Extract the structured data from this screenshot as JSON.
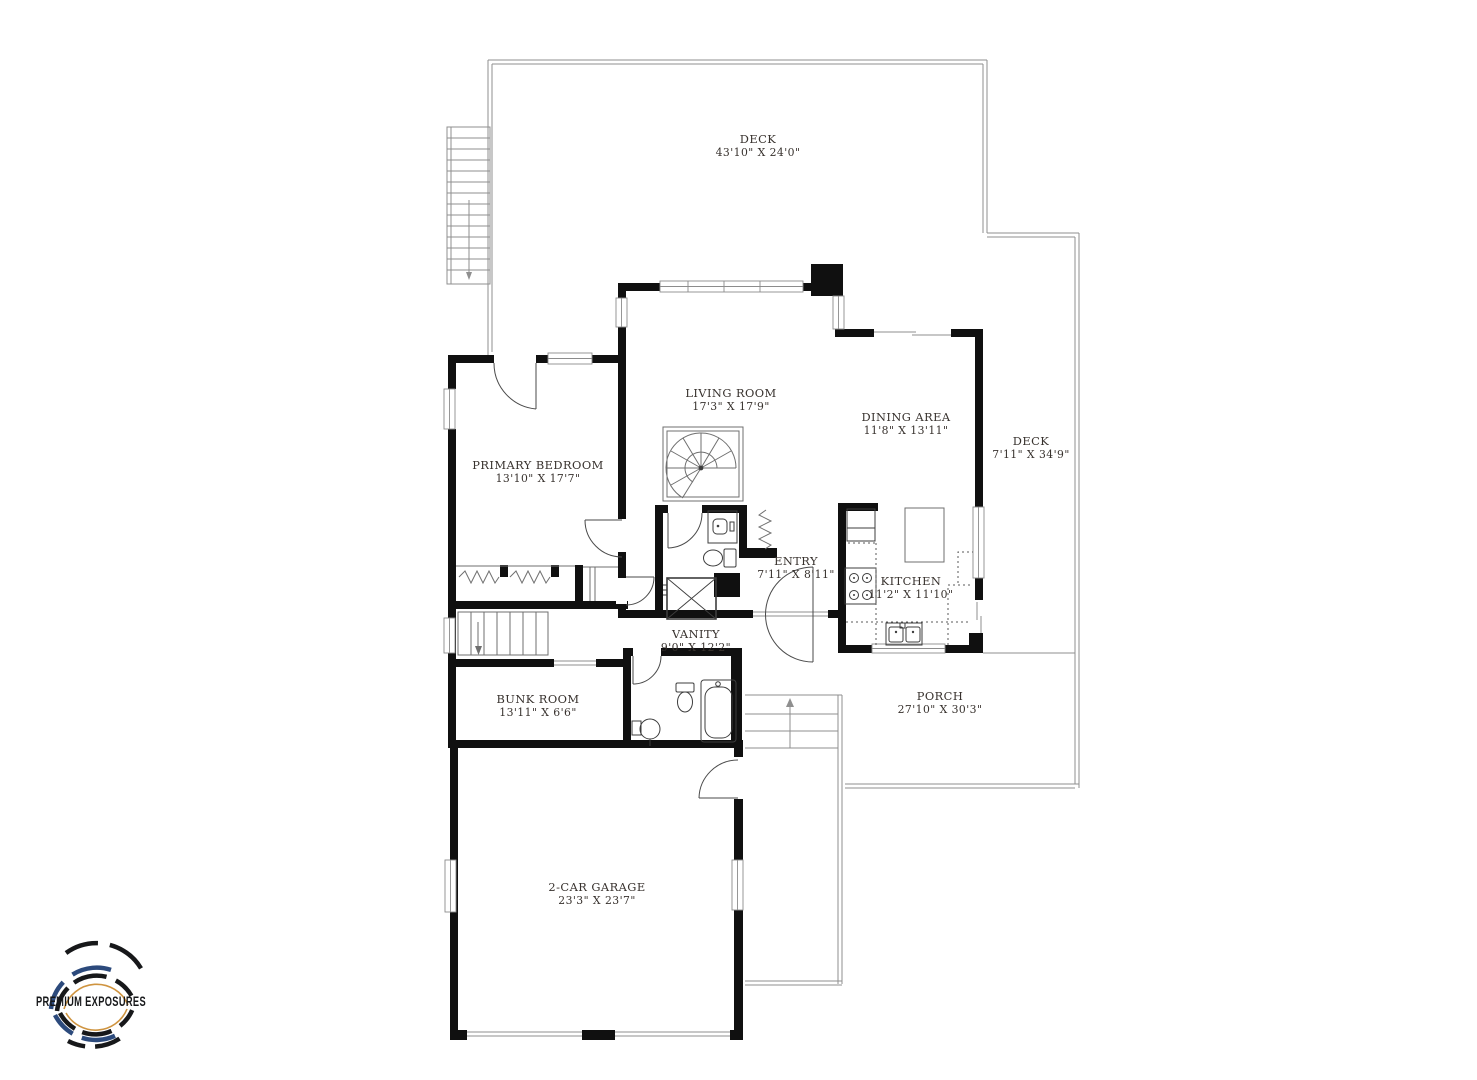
{
  "page": {
    "background": "#ffffff"
  },
  "logo": {
    "text": "PREMIUM EXPOSURES",
    "colors": {
      "black": "#17181a",
      "navy": "#2c4a7c",
      "gold": "#cf9440"
    }
  },
  "plan": {
    "wall_color": "#101010",
    "outline_color": "#8f8f8f",
    "text_color": "#38322e",
    "rooms": [
      {
        "id": "deck-top",
        "name": "DECK",
        "dims": "43'10\" X 24'0\""
      },
      {
        "id": "living-room",
        "name": "LIVING ROOM",
        "dims": "17'3\" X 17'9\""
      },
      {
        "id": "dining-area",
        "name": "DINING AREA",
        "dims": "11'8\" X 13'11\""
      },
      {
        "id": "deck-right",
        "name": "DECK",
        "dims": "7'11\" X 34'9\""
      },
      {
        "id": "primary-bedroom",
        "name": "PRIMARY BEDROOM",
        "dims": "13'10\" X 17'7\""
      },
      {
        "id": "entry",
        "name": "ENTRY",
        "dims": "7'11\" X 8'11\""
      },
      {
        "id": "kitchen",
        "name": "KITCHEN",
        "dims": "11'2\" X 11'10\""
      },
      {
        "id": "vanity",
        "name": "VANITY",
        "dims": "9'0\" X 12'2\""
      },
      {
        "id": "bunk-room",
        "name": "BUNK ROOM",
        "dims": "13'11\" X 6'6\""
      },
      {
        "id": "porch",
        "name": "PORCH",
        "dims": "27'10\" X 30'3\""
      },
      {
        "id": "garage",
        "name": "2-CAR GARAGE",
        "dims": "23'3\" X 23'7\""
      }
    ]
  }
}
